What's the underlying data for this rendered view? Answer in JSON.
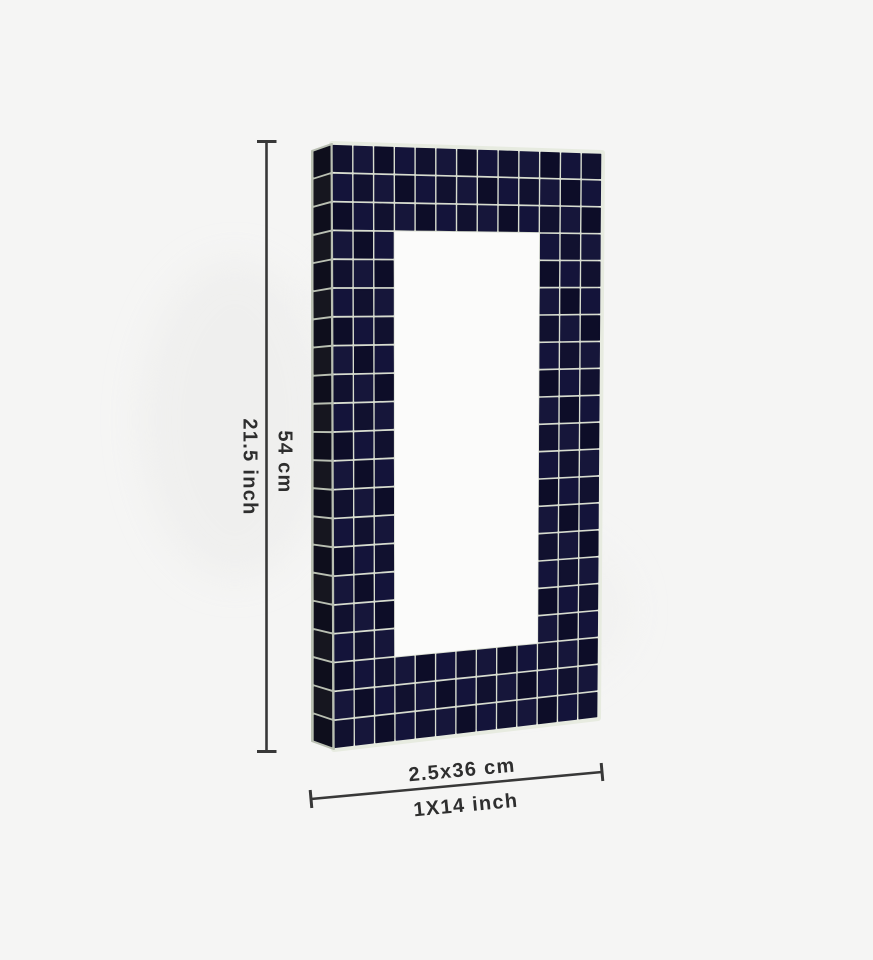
{
  "page": {
    "background_color": "#f5f5f4"
  },
  "product": {
    "name": "dark-blue-mosaic-tile-rectangular-frame",
    "tile_colors": [
      "#11112f",
      "#16163a",
      "#0d0d28",
      "#14143a"
    ],
    "grout_color": "#d7dccf",
    "rim_color": "#e7ebe0",
    "side_tile_color": "#0e0e1c",
    "side_tile_color_alt": "#16161f",
    "side_grout_color": "#b9bfb2",
    "window_color": "#fbfbfa",
    "grid": {
      "cols": 13,
      "rows": 21,
      "window": {
        "col_start": 3,
        "col_end": 9,
        "row_start": 3,
        "row_end": 17
      }
    }
  },
  "dimensions": {
    "line_color": "#383838",
    "label_color": "#2e2e2e",
    "height": {
      "metric": "54 cm",
      "imperial": "21.5 inch"
    },
    "width": {
      "metric": "2.5x36 cm",
      "imperial": "1X14 inch"
    }
  }
}
